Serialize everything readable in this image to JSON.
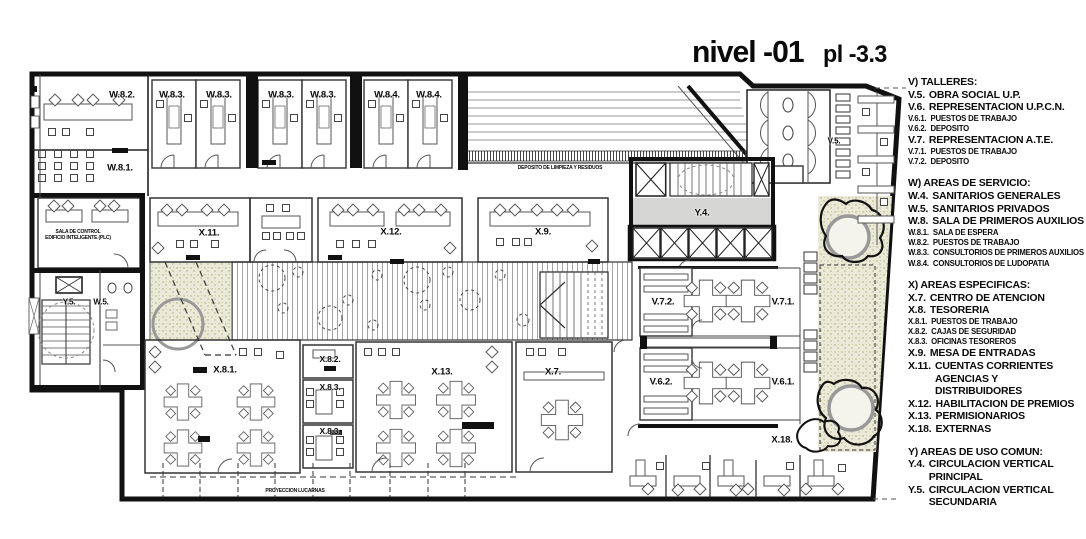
{
  "title": {
    "level": "nivel -01",
    "elevation": "pl -3.3"
  },
  "colors": {
    "ink": "#111111",
    "plan_gray": "#d6d6d4",
    "planter": "#ebead9",
    "hatch": "#888888"
  },
  "legend": {
    "sections": [
      {
        "heading": "V) TALLERES:",
        "items": [
          {
            "code": "V.5.",
            "label": "OBRA SOCIAL U.P.",
            "size": "lg"
          },
          {
            "code": "V.6.",
            "label": "REPRESENTACION U.P.C.N.",
            "size": "lg"
          },
          {
            "code": "V.6.1.",
            "label": "PUESTOS DE TRABAJO",
            "size": "sm"
          },
          {
            "code": "V.6.2.",
            "label": "DEPOSITO",
            "size": "sm"
          },
          {
            "code": "V.7.",
            "label": "REPRESENTACION A.T.E.",
            "size": "lg"
          },
          {
            "code": "V.7.1.",
            "label": "PUESTOS DE TRABAJO",
            "size": "sm"
          },
          {
            "code": "V.7.2.",
            "label": "DEPOSITO",
            "size": "sm"
          }
        ]
      },
      {
        "heading": "W) AREAS DE SERVICIO:",
        "items": [
          {
            "code": "W.4.",
            "label": "SANITARIOS GENERALES",
            "size": "lg"
          },
          {
            "code": "W.5.",
            "label": "SANITARIOS PRIVADOS",
            "size": "lg"
          },
          {
            "code": "W.8.",
            "label": "SALA DE PRIMEROS AUXILIOS",
            "size": "lg"
          },
          {
            "code": "W.8.1.",
            "label": "SALA DE ESPERA",
            "size": "sm"
          },
          {
            "code": "W.8.2.",
            "label": "PUESTOS DE TRABAJO",
            "size": "sm"
          },
          {
            "code": "W.8.3.",
            "label": "CONSULTORIOS DE PRIMEROS AUXILIOS",
            "size": "sm"
          },
          {
            "code": "W.8.4.",
            "label": "CONSULTORIOS DE LUDOPATIA",
            "size": "sm"
          }
        ]
      },
      {
        "heading": "X) AREAS ESPECIFICAS:",
        "items": [
          {
            "code": "X.7.",
            "label": "CENTRO DE ATENCION",
            "size": "lg"
          },
          {
            "code": "X.8.",
            "label": "TESORERIA",
            "size": "lg"
          },
          {
            "code": "X.8.1.",
            "label": "PUESTOS DE TRABAJO",
            "size": "sm"
          },
          {
            "code": "X.8.2.",
            "label": "CAJAS DE SEGURIDAD",
            "size": "sm"
          },
          {
            "code": "X.8.3.",
            "label": "OFICINAS TESOREROS",
            "size": "sm"
          },
          {
            "code": "X.9.",
            "label": "MESA DE ENTRADAS",
            "size": "lg"
          },
          {
            "code": "X.11.",
            "label": "CUENTAS CORRIENTES\nAGENCIAS Y DISTRIBUIDORES",
            "size": "lg"
          },
          {
            "code": "X.12.",
            "label": "HABILITACION DE PREMIOS",
            "size": "lg"
          },
          {
            "code": "X.13.",
            "label": "PERMISIONARIOS",
            "size": "lg"
          },
          {
            "code": "X.18.",
            "label": "EXTERNAS",
            "size": "lg"
          }
        ]
      },
      {
        "heading": "Y) AREAS DE USO COMUN:",
        "items": [
          {
            "code": "Y.4.",
            "label": "CIRCULACION VERTICAL\nPRINCIPAL",
            "size": "lg"
          },
          {
            "code": "Y.5.",
            "label": "CIRCULACION VERTICAL\nSECUNDARIA",
            "size": "lg"
          }
        ]
      }
    ]
  },
  "plan": {
    "room_labels": [
      {
        "id": "w82",
        "text": "W.8.2.",
        "x": 122,
        "y": 95
      },
      {
        "id": "w83-1",
        "text": "W.8.3.",
        "x": 172,
        "y": 95
      },
      {
        "id": "w83-2",
        "text": "W.8.3.",
        "x": 219,
        "y": 95
      },
      {
        "id": "w83-3",
        "text": "W.8.3.",
        "x": 281,
        "y": 95
      },
      {
        "id": "w83-4",
        "text": "W.8.3.",
        "x": 323,
        "y": 95
      },
      {
        "id": "w84-1",
        "text": "W.8.4.",
        "x": 387,
        "y": 95
      },
      {
        "id": "w84-2",
        "text": "W.8.4.",
        "x": 429,
        "y": 95
      },
      {
        "id": "w81",
        "text": "W.8.1.",
        "x": 120,
        "y": 168
      },
      {
        "id": "x11",
        "text": "X.11.",
        "x": 209,
        "y": 233
      },
      {
        "id": "x12",
        "text": "X.12.",
        "x": 391,
        "y": 232
      },
      {
        "id": "x9",
        "text": "X.9.",
        "x": 543,
        "y": 232
      },
      {
        "id": "y4",
        "text": "Y.4.",
        "x": 702,
        "y": 213
      },
      {
        "id": "v5",
        "text": "V.5.",
        "x": 834,
        "y": 141,
        "fs": 8
      },
      {
        "id": "v72",
        "text": "V.7.2.",
        "x": 663,
        "y": 302
      },
      {
        "id": "v71",
        "text": "V.7.1.",
        "x": 783,
        "y": 302
      },
      {
        "id": "v62",
        "text": "V.6.2.",
        "x": 661,
        "y": 382
      },
      {
        "id": "v61",
        "text": "V.6.1.",
        "x": 783,
        "y": 382
      },
      {
        "id": "x18",
        "text": "X.18.",
        "x": 782,
        "y": 440
      },
      {
        "id": "y5",
        "text": "Y.5.",
        "x": 69,
        "y": 302,
        "fs": 8
      },
      {
        "id": "w5",
        "text": "W.5.",
        "x": 101,
        "y": 302,
        "fs": 8
      },
      {
        "id": "x81",
        "text": "X.8.1.",
        "x": 225,
        "y": 370
      },
      {
        "id": "x82",
        "text": "X.8.2.",
        "x": 330,
        "y": 359,
        "fs": 8.5
      },
      {
        "id": "x83-1",
        "text": "X.8.3.",
        "x": 330,
        "y": 387,
        "fs": 8.5
      },
      {
        "id": "x83-2",
        "text": "X.8.3.",
        "x": 330,
        "y": 431,
        "fs": 8.5
      },
      {
        "id": "x13",
        "text": "X.13.",
        "x": 442,
        "y": 372
      },
      {
        "id": "x7",
        "text": "X.7.",
        "x": 553,
        "y": 372
      }
    ],
    "annotations": [
      {
        "id": "sala-de-control",
        "text": "SALA DE CONTROL\nEDIFICIO INTELIGENTE (PLC)",
        "x": 78,
        "y": 235,
        "fs": 5
      },
      {
        "id": "deposito-limpieza",
        "text": "DEPOSITO DE LIMPIEZA Y RESIDUOS",
        "x": 560,
        "y": 168,
        "fs": 5
      },
      {
        "id": "proyeccion-lucarnas",
        "text": "PROYECCION LUCARNAS",
        "x": 295,
        "y": 491,
        "fs": 5
      }
    ]
  }
}
